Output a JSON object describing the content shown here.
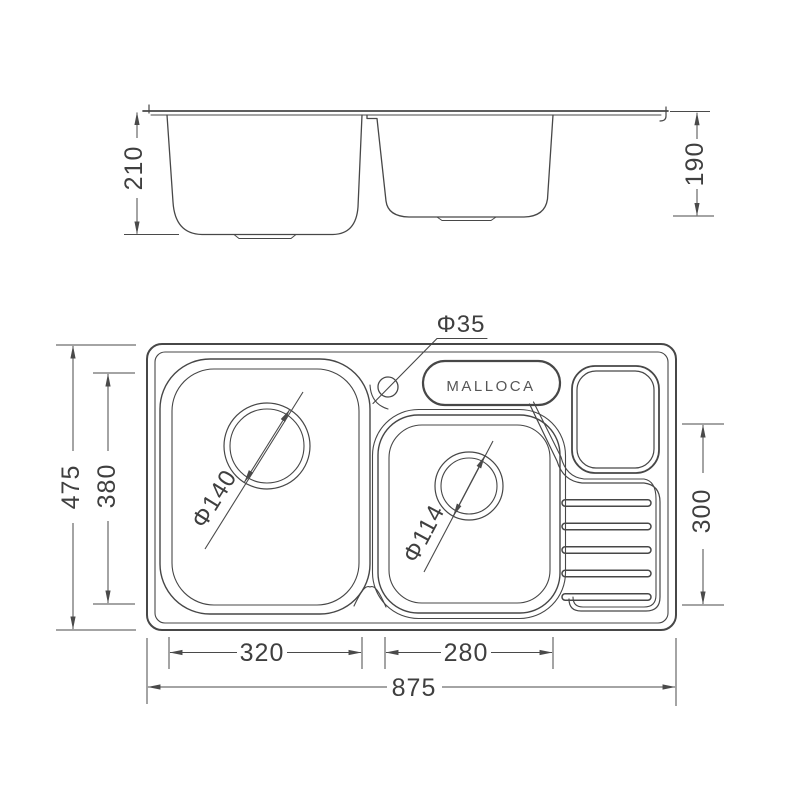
{
  "brand_label": "MALLOCA",
  "dimensions": {
    "side_view": {
      "left_bowl_depth": "210",
      "right_bowl_depth": "190"
    },
    "top_view": {
      "overall_length": "875",
      "overall_width": "475",
      "left_bowl_length": "320",
      "right_bowl_length": "280",
      "left_bowl_width": "380",
      "right_bowl_width": "300",
      "left_drain_diameter": "Φ140",
      "right_drain_diameter": "Φ114",
      "tap_hole_diameter": "Φ35"
    }
  },
  "colors": {
    "line": "#474747",
    "dim_line": "#4a4a4a",
    "text": "#3f3f3f"
  }
}
